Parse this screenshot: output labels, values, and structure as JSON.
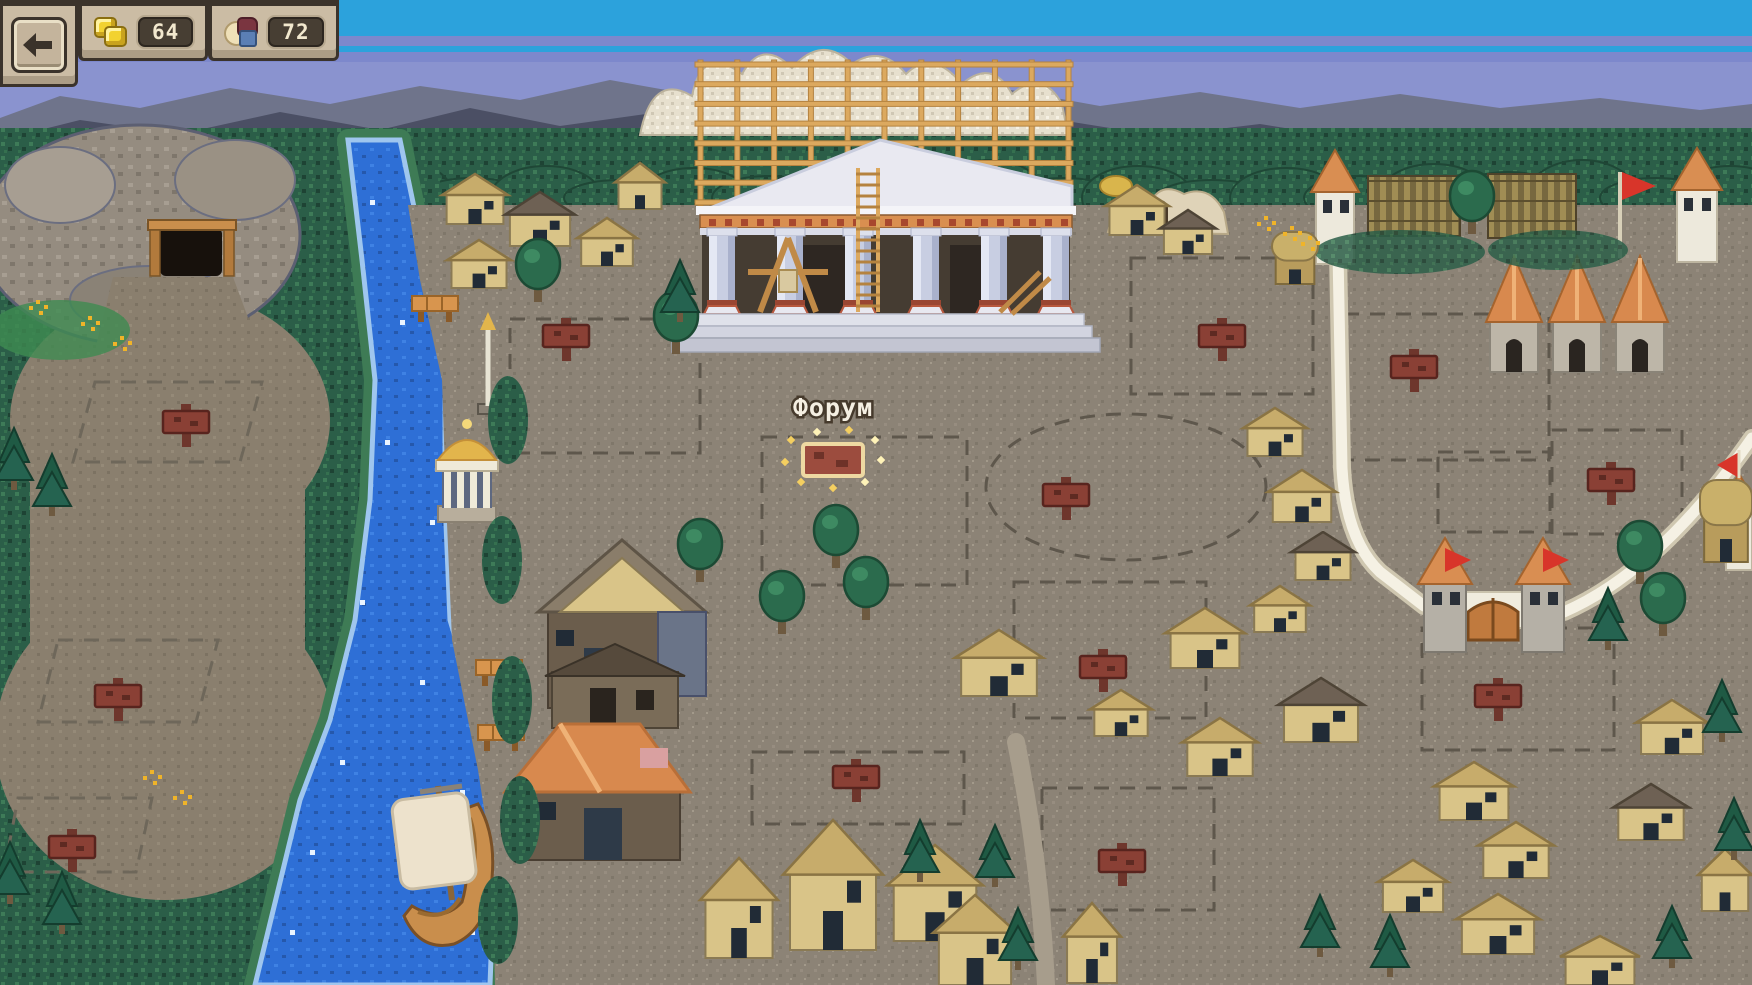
{
  "hud": {
    "back_button": {
      "icon": "arrow-left-icon"
    },
    "resources": [
      {
        "name": "gold",
        "icon": "gold-coins-icon",
        "value": "64"
      },
      {
        "name": "goods",
        "icon": "goods-icon",
        "value": "72"
      }
    ]
  },
  "map": {
    "selected_site": {
      "label": "Форум",
      "x": 833,
      "y": 460
    },
    "signposts": [
      [
        566,
        336
      ],
      [
        1222,
        336
      ],
      [
        1414,
        367
      ],
      [
        186,
        422
      ],
      [
        1066,
        495
      ],
      [
        1611,
        480
      ],
      [
        1103,
        667
      ],
      [
        856,
        777
      ],
      [
        1498,
        696
      ],
      [
        1122,
        861
      ],
      [
        118,
        696
      ],
      [
        72,
        847
      ]
    ],
    "docks": [
      [
        412,
        296
      ],
      [
        476,
        660
      ],
      [
        478,
        725
      ]
    ],
    "houses": [
      [
        442,
        174,
        66,
        50,
        "k"
      ],
      [
        505,
        192,
        70,
        54,
        "d"
      ],
      [
        577,
        218,
        60,
        48,
        "k"
      ],
      [
        447,
        240,
        64,
        48,
        "k"
      ],
      [
        615,
        163,
        50,
        46,
        "k"
      ],
      [
        1105,
        185,
        64,
        50,
        "k"
      ],
      [
        1160,
        210,
        56,
        44,
        "d"
      ],
      [
        1272,
        232,
        46,
        52,
        "s"
      ],
      [
        1243,
        408,
        64,
        48,
        "k"
      ],
      [
        1268,
        470,
        68,
        52,
        "k"
      ],
      [
        1291,
        532,
        64,
        48,
        "d"
      ],
      [
        1250,
        586,
        60,
        46,
        "k"
      ],
      [
        955,
        630,
        88,
        66,
        "k"
      ],
      [
        1165,
        608,
        80,
        60,
        "k"
      ],
      [
        1182,
        718,
        76,
        58,
        "k"
      ],
      [
        1278,
        678,
        86,
        64,
        "d"
      ],
      [
        1090,
        690,
        62,
        46,
        "k"
      ],
      [
        700,
        858,
        78,
        100,
        "k"
      ],
      [
        783,
        820,
        100,
        130,
        "k"
      ],
      [
        887,
        845,
        96,
        96,
        "k"
      ],
      [
        933,
        895,
        84,
        90,
        "k"
      ],
      [
        1063,
        903,
        58,
        80,
        "k"
      ],
      [
        1434,
        762,
        80,
        58,
        "k"
      ],
      [
        1478,
        822,
        76,
        56,
        "k"
      ],
      [
        1378,
        860,
        70,
        52,
        "k"
      ],
      [
        1456,
        894,
        84,
        60,
        "k"
      ],
      [
        1560,
        936,
        80,
        49,
        "k"
      ],
      [
        1613,
        784,
        76,
        56,
        "d"
      ],
      [
        1698,
        849,
        54,
        62,
        "k"
      ],
      [
        1636,
        700,
        72,
        54,
        "k"
      ],
      [
        1700,
        480,
        52,
        82,
        "s"
      ]
    ],
    "round_trees": [
      [
        676,
        352
      ],
      [
        700,
        580
      ],
      [
        782,
        632
      ],
      [
        866,
        618
      ],
      [
        836,
        566
      ],
      [
        1640,
        582
      ],
      [
        1663,
        634
      ],
      [
        1472,
        232
      ],
      [
        538,
        300
      ]
    ],
    "pine_trees": [
      [
        680,
        320
      ],
      [
        920,
        880
      ],
      [
        995,
        885
      ],
      [
        1018,
        968
      ],
      [
        1320,
        955
      ],
      [
        1390,
        975
      ],
      [
        1672,
        966
      ],
      [
        1608,
        648
      ],
      [
        1722,
        740
      ],
      [
        1734,
        858
      ],
      [
        14,
        488
      ],
      [
        52,
        514
      ],
      [
        10,
        902
      ],
      [
        62,
        932
      ]
    ],
    "plot_rects": [
      [
        510,
        319,
        190,
        134
      ],
      [
        762,
        437,
        205,
        148
      ],
      [
        1131,
        258,
        182,
        136
      ],
      [
        1344,
        314,
        205,
        146
      ],
      [
        1014,
        582,
        192,
        136
      ],
      [
        752,
        752,
        212,
        72
      ],
      [
        1042,
        788,
        172,
        122
      ],
      [
        1422,
        628,
        192,
        122
      ],
      [
        1438,
        452,
        112,
        80
      ],
      [
        1552,
        430,
        130,
        104
      ]
    ],
    "plot_polys": [
      [
        [
          95,
          382
        ],
        [
          262,
          382
        ],
        [
          240,
          462
        ],
        [
          73,
          462
        ]
      ],
      [
        [
          58,
          640
        ],
        [
          218,
          640
        ],
        [
          196,
          722
        ],
        [
          38,
          722
        ]
      ],
      [
        [
          18,
          798
        ],
        [
          152,
          798
        ],
        [
          136,
          872
        ],
        [
          4,
          872
        ]
      ]
    ],
    "plot_oval": {
      "cx": 1126,
      "cy": 487,
      "rx": 140,
      "ry": 73
    },
    "flowers": [
      [
        36,
        300
      ],
      [
        88,
        316
      ],
      [
        120,
        336
      ],
      [
        1264,
        216
      ],
      [
        1290,
        226
      ],
      [
        1308,
        236
      ],
      [
        150,
        770
      ],
      [
        180,
        790
      ]
    ],
    "palette": {
      "sky": "#2CA2DC",
      "sky_band": "#7D88CC",
      "horizon": "#8A93CF",
      "mountain_back": "#6F748B",
      "mountain_front": "#4B4F64",
      "forest": "#2B5E48",
      "ground": "#8C8376",
      "water": "#2E6FD6",
      "scaffold": "#DCA95F",
      "marble": "#E9E9F1",
      "fort_wall": "#F5F1E4",
      "roof_orange": "#D8894E",
      "flag_red": "#D8352A",
      "sign_board": "#8A4035",
      "selected_border": "#EED9A2",
      "sparkle": "#F4CF60",
      "roof_khaki": "#C7AC6B",
      "roof_dark": "#6E6154",
      "house_wall": "#D9C488"
    }
  }
}
